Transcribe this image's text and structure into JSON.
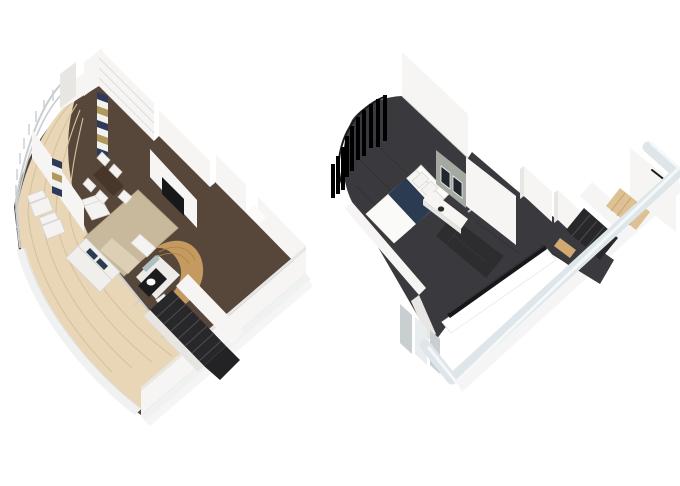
{
  "canvas": {
    "width": 680,
    "height": 486,
    "background": "#ffffff"
  },
  "palette": {
    "canvas_bg": "#ffffff",
    "deck_wood": "#e8d6b6",
    "deck_plank": "#d7c29e",
    "floor_dark_wood": "#57473b",
    "rug": "#c8b89c",
    "rug_edge": "#b9a88a",
    "wall_face": "#f6f5f3",
    "wall_side": "#e7e6e3",
    "wall_outline": "#dedcd9",
    "exterior_band": "#f0f2f2",
    "exterior_cool": "#dfe6ea",
    "exterior_cool_edge": "#f5f8f9",
    "glass_frame": "#c9ced1",
    "glass_pane": "#e9edee",
    "curtain_navy": "#2f3a5a",
    "curtain_tan": "#b1995e",
    "curtain_white": "#f1f1ee",
    "table_wood": "#473629",
    "chair_white": "#f4f3f1",
    "chair_outline": "#d8d5d0",
    "sofa_white": "#f1efeb",
    "coffee_table": "#dccfb6",
    "credenza_wood": "#b8905e",
    "credenza_side": "#9a7448",
    "tv_black": "#17181a",
    "pod_wood": "#c59a61",
    "pod_wood_line": "#ad8049",
    "pod_floor": "#ecebe7",
    "counter_black": "#1c1c1e",
    "mirror_glass": "#aebfc4",
    "stair_dark": "#28282b",
    "stair_tread": "#4b4b50",
    "carpet_dark": "#3a3a3e",
    "carpet_line": "#313135",
    "bed_white": "#f6f5f2",
    "bed_navy": "#2b3b51",
    "headboard": "#fcfcfa",
    "pillow_outline": "#d9d6d0",
    "tile_wall": "#a4aaa2",
    "tile_mirror": "#20262b",
    "bath_floor": "#2d2d30",
    "shower_glass": "#cfe3e8",
    "stair_wood": "#ddc093",
    "stair_wood_line": "#c2a06c",
    "wood_desk": "#d2a971",
    "void_white": "#ffffff",
    "void_rail": "#17171a",
    "rail_black": "#1b1b1d",
    "shadow_soft": "rgba(60,60,60,0.05)"
  },
  "plans": [
    {
      "id": "lower-level-floor-plan",
      "features": [
        "balcony-deck",
        "balcony-railing",
        "lounge-chairs",
        "glass-doors",
        "living-room-rug",
        "sofa",
        "armchair",
        "ottoman",
        "coffee-table",
        "dining-table",
        "dining-chairs",
        "striped-curtains",
        "tv",
        "tv-console",
        "bathroom-pod",
        "vanity-counter",
        "mirror",
        "toilet",
        "staircase",
        "entry-hall",
        "exterior-walls"
      ]
    },
    {
      "id": "upper-level-floor-plan",
      "features": [
        "bedroom-carpet",
        "bed",
        "headboard",
        "pillows",
        "curtains",
        "curtain-rail",
        "tile-wall",
        "vanity",
        "vanity-mirrors",
        "shower-glass",
        "bathroom-floor",
        "hallway-carpet",
        "wardrobe-walls",
        "staircase",
        "stair-handrail",
        "overlook-glass-rail",
        "void-opening",
        "window-glass",
        "exterior-walls"
      ]
    }
  ]
}
